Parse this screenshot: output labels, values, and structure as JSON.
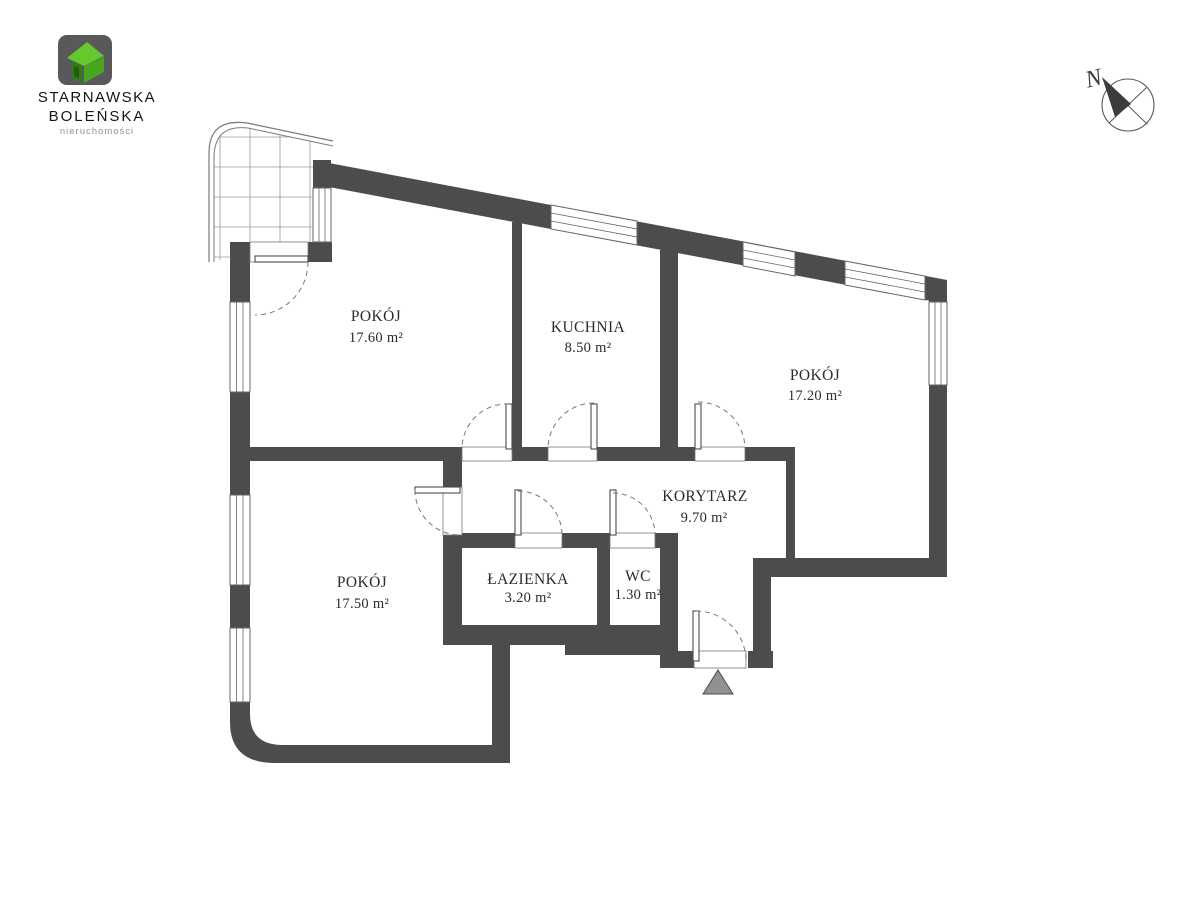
{
  "branding": {
    "line1": "STARNAWSKA",
    "line2": "BOLEŃSKA",
    "line3": "nieruchomości"
  },
  "compass": {
    "label": "N"
  },
  "rooms": [
    {
      "id": "pokoj-top-left",
      "name": "POKÓJ",
      "area": "17.60 m²"
    },
    {
      "id": "kuchnia",
      "name": "KUCHNIA",
      "area": "8.50 m²"
    },
    {
      "id": "pokoj-right",
      "name": "POKÓJ",
      "area": "17.20 m²"
    },
    {
      "id": "korytarz",
      "name": "KORYTARZ",
      "area": "9.70 m²"
    },
    {
      "id": "pokoj-bottom-left",
      "name": "POKÓJ",
      "area": "17.50 m²"
    },
    {
      "id": "lazienka",
      "name": "ŁAZIENKA",
      "area": "3.20 m²"
    },
    {
      "id": "wc",
      "name": "WC",
      "area": "1.30 m²"
    }
  ],
  "colors": {
    "wall": "#4c4c4e",
    "thin_line": "#6e6e6e",
    "logo_square": "#59595b",
    "logo_green_bright": "#66c72e",
    "logo_green_mid": "#49a61f",
    "logo_green_dark": "#2e7d15",
    "entrance_marker": "#919191"
  }
}
